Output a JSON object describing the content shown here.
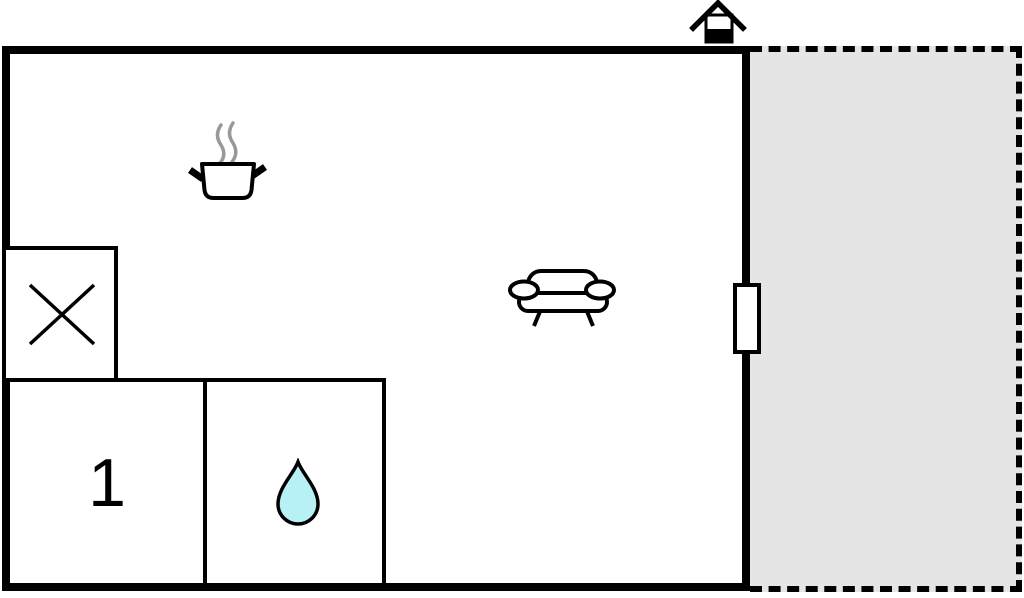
{
  "floorplan": {
    "type": "apartment-floor-plan",
    "bedroom": {
      "label": "1"
    },
    "rooms": [
      {
        "id": "living-area"
      },
      {
        "id": "closet-crossed-square"
      },
      {
        "id": "bedroom",
        "label": "1"
      },
      {
        "id": "bathroom"
      },
      {
        "id": "terrace"
      }
    ],
    "icons": [
      "house-icon",
      "cooking-pot-icon",
      "steam-icon",
      "crossed-square-icon",
      "sofa-icon",
      "water-drop-icon",
      "window-marker"
    ],
    "colors": {
      "wall": "#000000",
      "terrace_fill": "#e5e5e5",
      "steam": "#999999",
      "water_drop_fill": "#b7f1f5",
      "background": "#ffffff"
    }
  }
}
